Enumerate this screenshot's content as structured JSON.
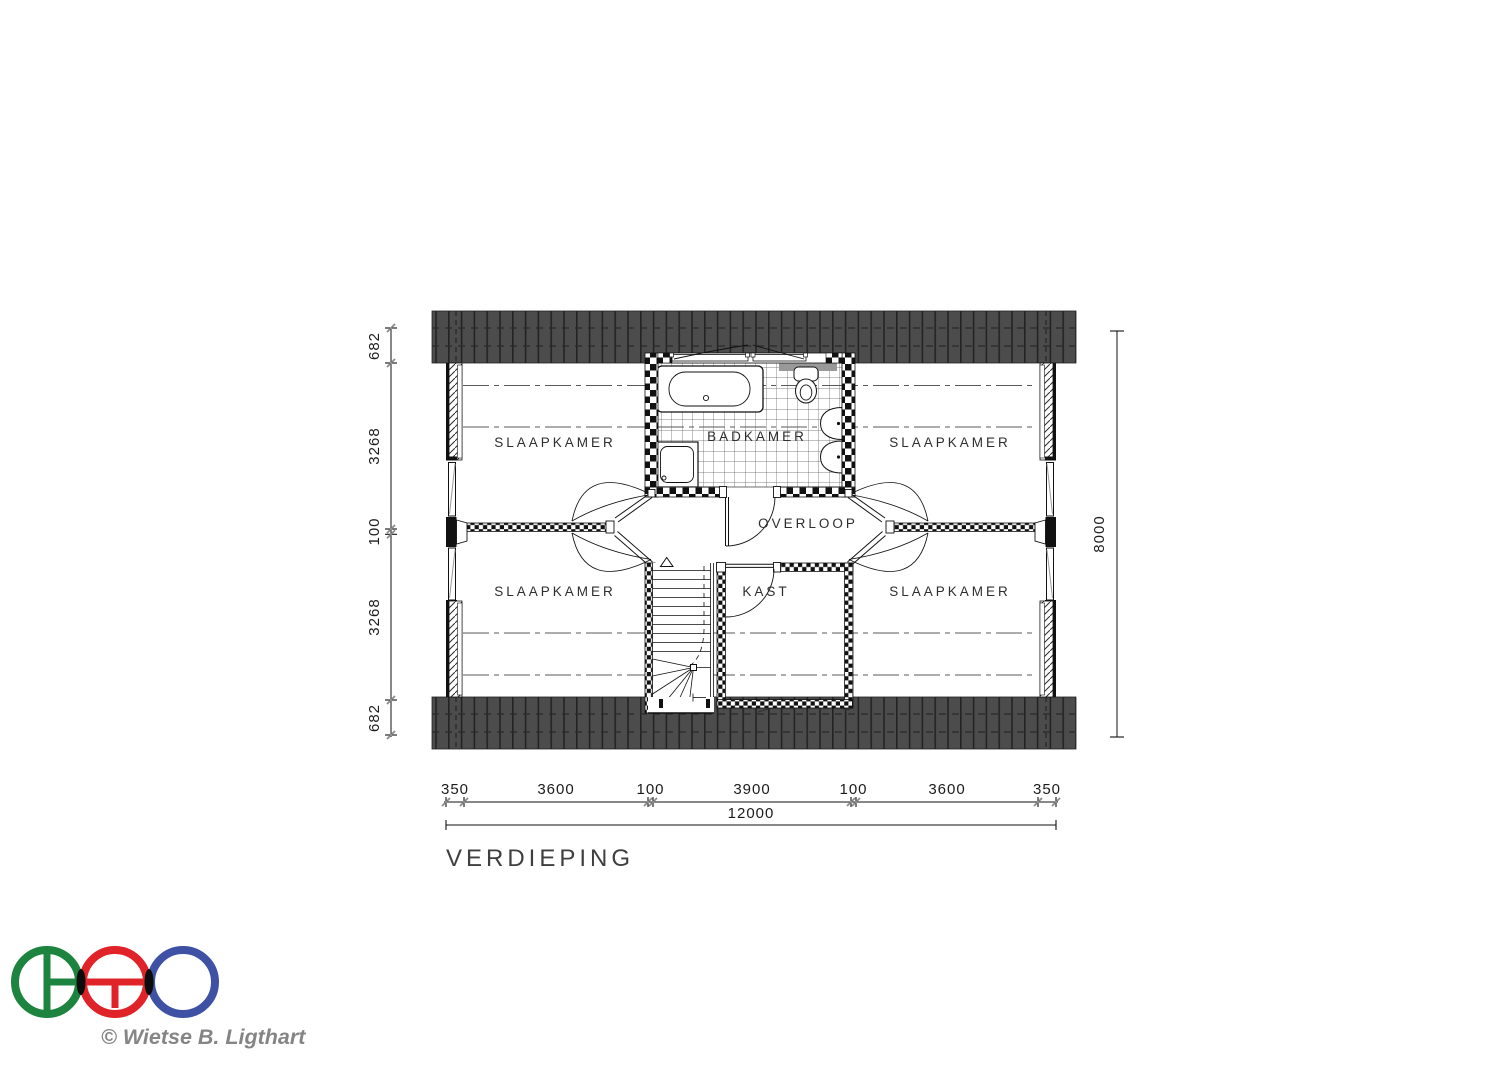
{
  "title": "VERDIEPING",
  "copyright": "© Wietse B. Ligthart",
  "rooms": {
    "top_left": "SLAAPKAMER",
    "top_right": "SLAAPKAMER",
    "bottom_left": "SLAAPKAMER",
    "bottom_right": "SLAAPKAMER",
    "bathroom": "BADKAMER",
    "landing": "OVERLOOP",
    "closet": "KAST"
  },
  "dim_left": {
    "segments": [
      "682",
      "3268",
      "100",
      "3268",
      "682"
    ]
  },
  "dim_right": {
    "total": "8000"
  },
  "dim_bottom": {
    "segments": [
      "350",
      "3600",
      "100",
      "3900",
      "100",
      "3600",
      "350"
    ],
    "total": "12000"
  },
  "colors": {
    "roof": "#4c4c4c",
    "logo_green": "#1d8440",
    "logo_red": "#e02328",
    "logo_blue": "#3f51a5",
    "lens_black": "#0c0c0c"
  }
}
